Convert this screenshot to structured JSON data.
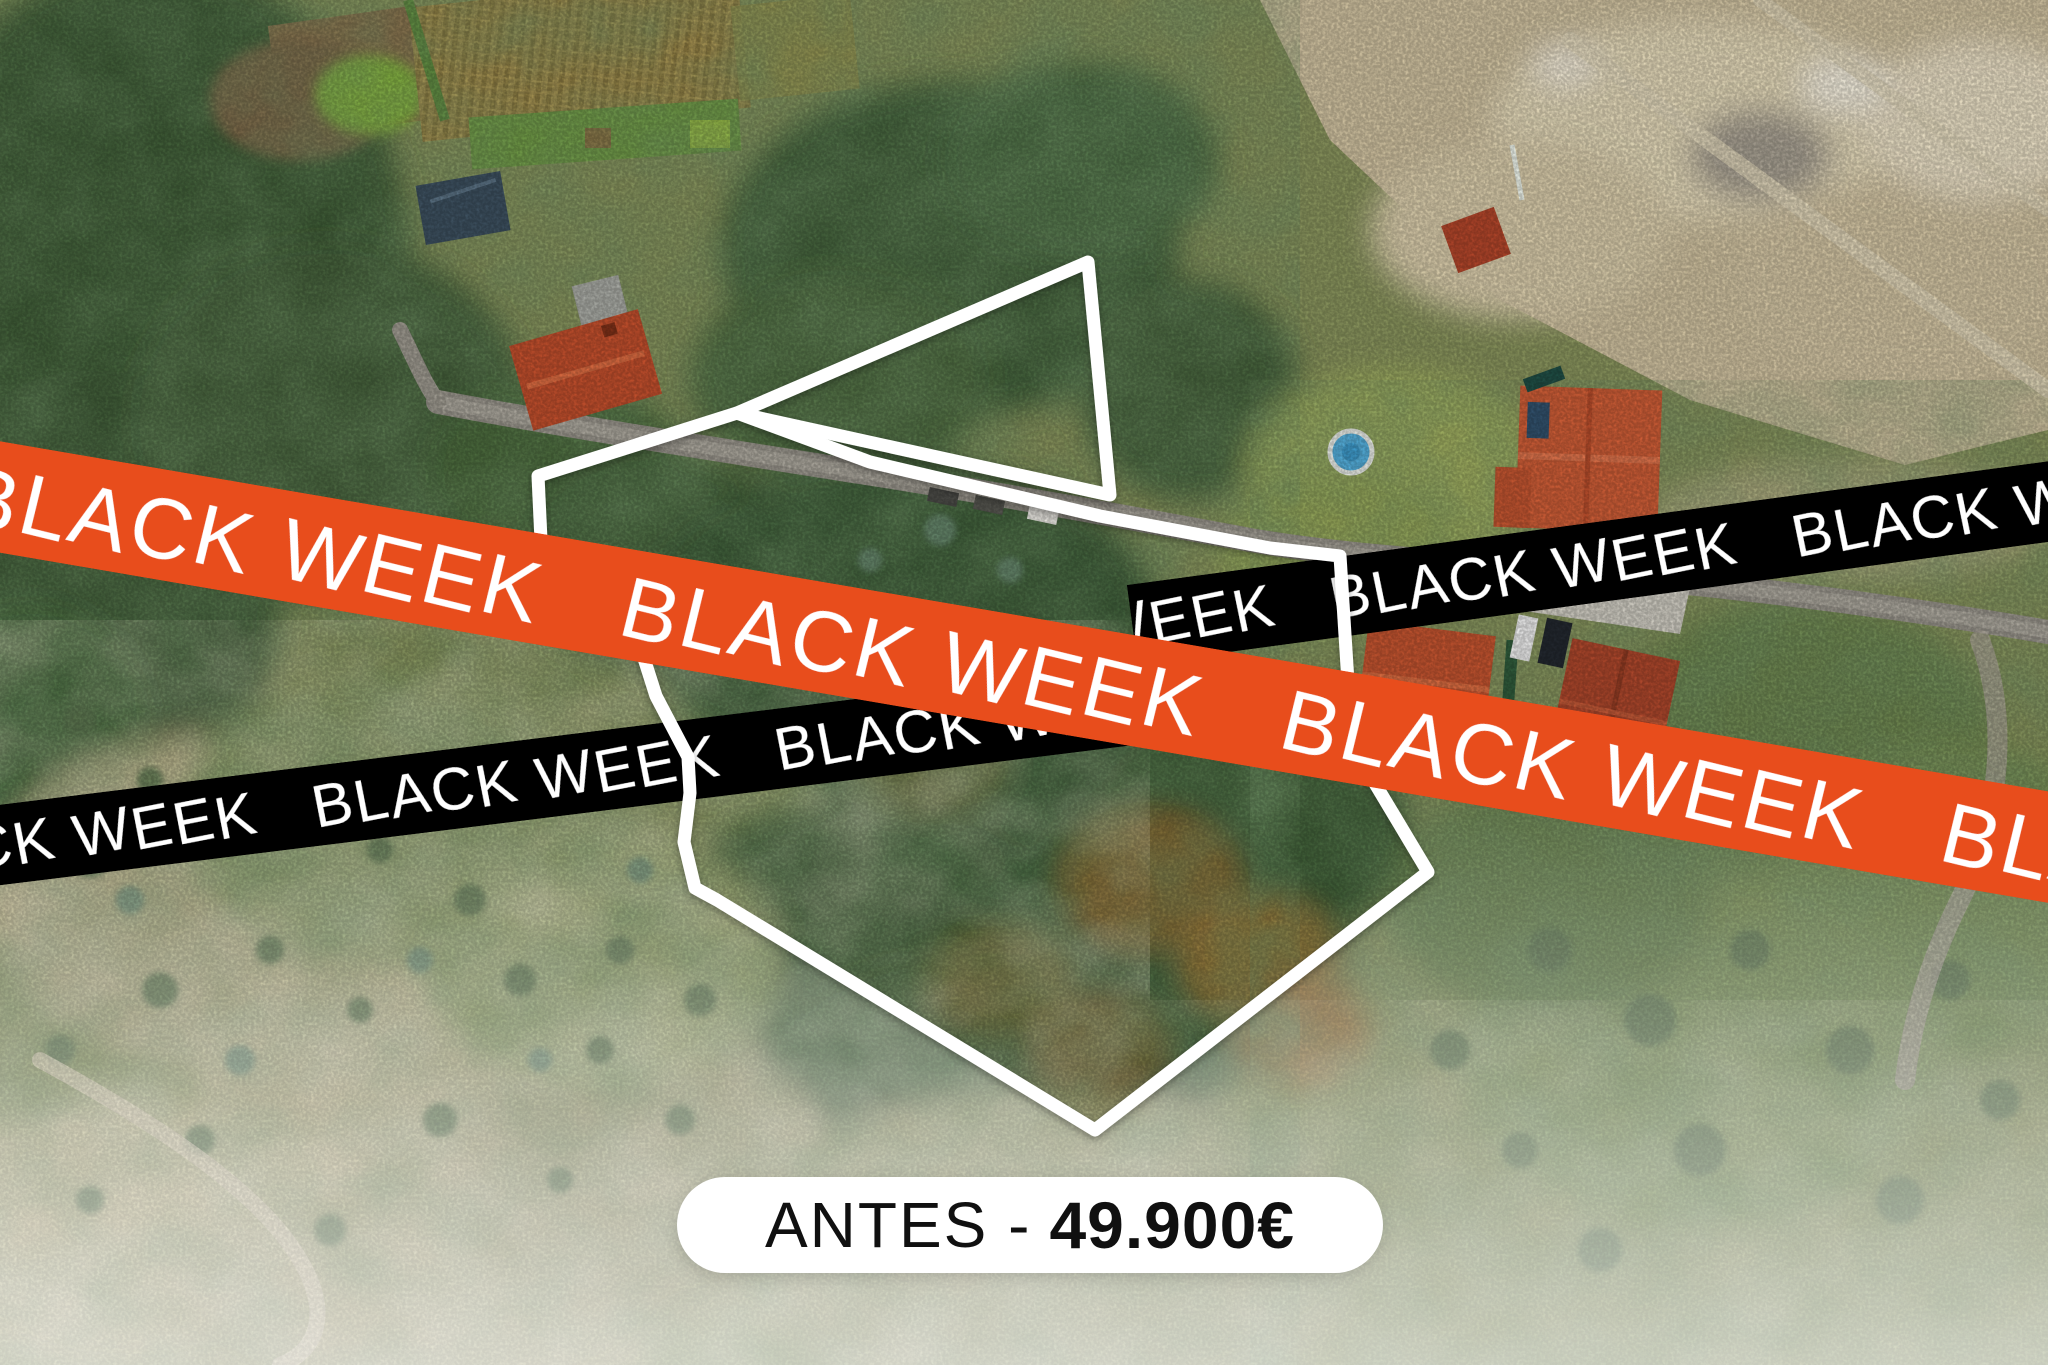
{
  "banners": {
    "word": "BLACK WEEK",
    "orange_text": "BLACK WEEK   BLACK WEEK   BLACK WEEK   BLACK WEEK   BLACK WEEK   BLACK WEEK",
    "black_left_text": "BLACK WEEK   BLACK WEEK   BLACK WEEK   BLACK WEEK",
    "black_right_text": "BLACK WEEK   BLACK WEEK   BLACK WEEK   BLACK WEEK",
    "orange_color": "#e84e1b",
    "black_color": "#060606",
    "text_color": "#ffffff"
  },
  "price_badge": {
    "prefix": "ANTES -",
    "amount": "49.900€",
    "background": "#ffffff",
    "text_color": "#101010"
  },
  "property_outline": {
    "color": "#ffffff"
  }
}
